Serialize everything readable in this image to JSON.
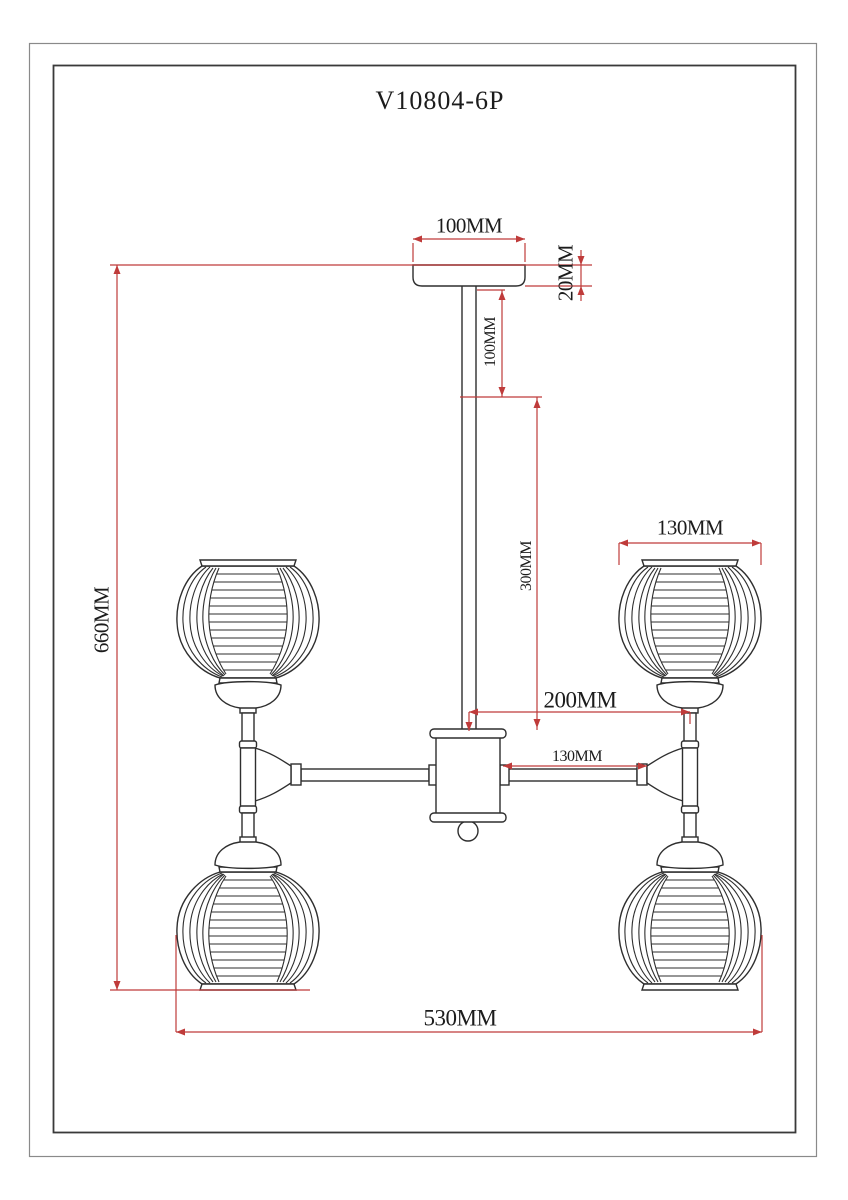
{
  "title": "V10804-6P",
  "dimensions": {
    "canopy_width": "100MM",
    "canopy_height": "20MM",
    "stem_upper_section": "100MM",
    "stem_lower_section": "300MM",
    "center_to_side_arm": "200MM",
    "arm_length": "130MM",
    "shade_diameter": "130MM",
    "overall_height": "660MM",
    "overall_width": "530MM"
  },
  "colors": {
    "dimension_lines": "#bf3b3a",
    "drawing_outline": "#2e2e2e",
    "background": "#ffffff"
  }
}
